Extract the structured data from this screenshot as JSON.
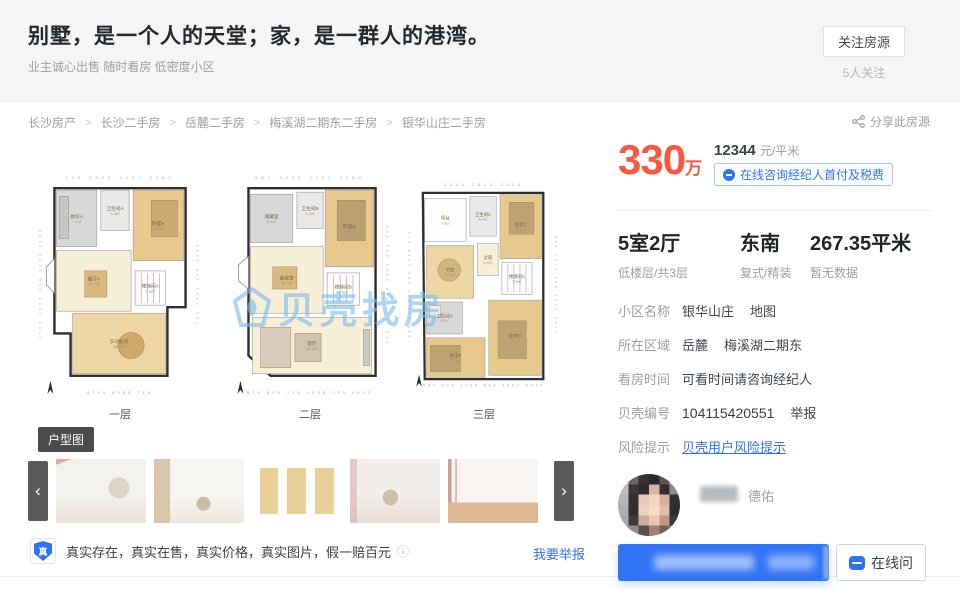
{
  "hero": {
    "title": "别墅，是一个人的天堂；家，是一群人的港湾。",
    "subtitle": "业主诚心出售 随时看房 低密度小区",
    "follow_button": "关注房源",
    "follow_count": "5人关注"
  },
  "breadcrumb": {
    "items": [
      "长沙房产",
      "长沙二手房",
      "岳麓二手房",
      "梅溪湖二期东二手房",
      "银华山庄二手房"
    ],
    "separator": ">",
    "share_label": "分享此房源"
  },
  "price": {
    "total": "330",
    "total_unit": "万",
    "unit_price": "12344",
    "unit_label": "元/平米",
    "consult_button": "在线咨询经纪人首付及税费"
  },
  "stats": [
    {
      "value": "5室2厅",
      "sub": "低楼层/共3层"
    },
    {
      "value": "东南",
      "sub": "复式/精装"
    },
    {
      "value": "267.35平米",
      "sub": "暂无数据"
    }
  ],
  "details": [
    {
      "label": "小区名称",
      "value": "银华山庄",
      "extra": "地图"
    },
    {
      "label": "所在区域",
      "value": "岳麓",
      "extra": "梅溪湖二期东"
    },
    {
      "label": "看房时间",
      "value": "可看时间请咨询经纪人",
      "extra": ""
    },
    {
      "label": "贝壳编号",
      "value": "104115420551",
      "extra": "举报"
    },
    {
      "label": "风险提示",
      "value": "贝壳用户风险提示",
      "extra": ""
    }
  ],
  "agent": {
    "brand": "德佑",
    "chat_button": "在线问"
  },
  "gallery": {
    "type_tag": "户型图",
    "prev_arrow": "‹",
    "next_arrow": "›"
  },
  "authenticity": {
    "badge": "真",
    "text": "真实存在，真实在售，真实价格，真实图片，假一赔百元",
    "info_icon": "ⓘ",
    "report_link": "我要举报"
  },
  "watermark": {
    "text": "贝壳找房"
  },
  "colors": {
    "accent_red": "#fa5741",
    "accent_blue": "#3072f6"
  },
  "floorplans": [
    {
      "caption": "一层",
      "dims_top": "719  3225  2437  3080",
      "dims_bottom": "4745  6085  719",
      "dims_left": "1767 1152 908 1262 2162",
      "dims_right": "463 4031 176 1144",
      "outline": "20,18 150,18 150,136 132,136 132,204 36,204 36,162 20,162",
      "bay": "12,96 20,88 20,122 12,114",
      "rooms": [
        {
          "x": 22,
          "y": 20,
          "w": 40,
          "h": 56,
          "fill": "gray",
          "label": "厨房A",
          "area": "7.4㎡"
        },
        {
          "x": 66,
          "y": 20,
          "w": 28,
          "h": 40,
          "fill": "lightgray",
          "label": "卫生间A",
          "area": "5.4㎡"
        },
        {
          "x": 98,
          "y": 20,
          "w": 50,
          "h": 70,
          "fill": "wood",
          "label": "卧室A",
          "area": "13.5㎡"
        },
        {
          "x": 22,
          "y": 80,
          "w": 74,
          "h": 60,
          "fill": "cream",
          "label": "餐厅A",
          "area": "25.2㎡"
        },
        {
          "x": 100,
          "y": 100,
          "w": 30,
          "h": 34,
          "fill": "white",
          "label": "楼梯间A",
          "area": "6.3㎡",
          "stairs": true
        },
        {
          "x": 38,
          "y": 142,
          "w": 92,
          "h": 60,
          "fill": "tan",
          "label": "多功能间",
          "area": "38.4㎡"
        }
      ],
      "furniture": [
        {
          "type": "rect",
          "x": 50,
          "y": 100,
          "w": 22,
          "h": 26,
          "fill": "#d9b97e"
        },
        {
          "type": "rect",
          "x": 116,
          "y": 30,
          "w": 26,
          "h": 36,
          "fill": "#cba96f"
        },
        {
          "type": "circle",
          "cx": 96,
          "cy": 174,
          "r": 13,
          "fill": "#cfa969"
        },
        {
          "type": "rect",
          "x": 25,
          "y": 26,
          "w": 9,
          "h": 42,
          "fill": "#c6c6c6"
        }
      ]
    },
    {
      "caption": "二层",
      "dims_top": "667  3309  2792  3084",
      "dims_bottom": "870 825 719 1248 735  4033",
      "dims_left": "",
      "dims_right": "748 2122 508 1084 825 407",
      "outline": "24,18 150,18 150,204 46,204 24,184",
      "bay": "14,94 24,86 24,118 14,110",
      "rooms": [
        {
          "x": 26,
          "y": 24,
          "w": 42,
          "h": 48,
          "fill": "gray",
          "label": "储藏室",
          "area": "6.3㎡"
        },
        {
          "x": 72,
          "y": 22,
          "w": 26,
          "h": 36,
          "fill": "lightgray",
          "label": "卫生间B",
          "area": "4.3㎡"
        },
        {
          "x": 100,
          "y": 20,
          "w": 48,
          "h": 76,
          "fill": "wood",
          "label": "卧室B",
          "area": "15.9㎡"
        },
        {
          "x": 26,
          "y": 76,
          "w": 72,
          "h": 66,
          "fill": "cream",
          "label": "起居室",
          "area": "19.9㎡"
        },
        {
          "x": 102,
          "y": 102,
          "w": 32,
          "h": 32,
          "fill": "white",
          "label": "楼梯间B",
          "area": "5.6㎡",
          "stairs": true
        },
        {
          "x": 28,
          "y": 146,
          "w": 118,
          "h": 56,
          "fill": "cream",
          "label": "客厅",
          "area": "44.5㎡"
        }
      ],
      "furniture": [
        {
          "type": "rect",
          "x": 48,
          "y": 96,
          "w": 24,
          "h": 22,
          "fill": "#d9b97e"
        },
        {
          "type": "rect",
          "x": 112,
          "y": 30,
          "w": 28,
          "h": 40,
          "fill": "#b99f72"
        },
        {
          "type": "rect",
          "x": 36,
          "y": 156,
          "w": 30,
          "h": 40,
          "fill": "#d8cdbc"
        },
        {
          "type": "rect",
          "x": 70,
          "y": 162,
          "w": 26,
          "h": 28,
          "fill": "#cfc4b0"
        },
        {
          "type": "rect",
          "x": 138,
          "y": 158,
          "w": 6,
          "h": 36,
          "fill": "#c9c9c9"
        }
      ]
    },
    {
      "caption": "三层",
      "dims_top": "3044  2813  3024",
      "dims_bottom": "667 909 1233 890 1307  3011",
      "dims_left": "948 672 905 994 1773 972",
      "dims_right": "1747 1024 457 2727 949",
      "outline": "20,16 148,16 148,214 22,214",
      "bay": "",
      "rooms": [
        {
          "x": 22,
          "y": 22,
          "w": 44,
          "h": 46,
          "fill": "white",
          "label": "阳台",
          "area": "7.3㎡"
        },
        {
          "x": 70,
          "y": 20,
          "w": 28,
          "h": 42,
          "fill": "lightgray",
          "label": "卫生间C",
          "area": "6.4㎡"
        },
        {
          "x": 102,
          "y": 18,
          "w": 44,
          "h": 68,
          "fill": "wood",
          "label": "卧室C",
          "area": "15.8㎡"
        },
        {
          "x": 24,
          "y": 72,
          "w": 50,
          "h": 56,
          "fill": "tan",
          "label": "书房",
          "area": "14.5㎡"
        },
        {
          "x": 78,
          "y": 70,
          "w": 22,
          "h": 34,
          "fill": "cream",
          "label": "过道",
          "area": "4.9㎡"
        },
        {
          "x": 104,
          "y": 90,
          "w": 32,
          "h": 34,
          "fill": "white",
          "label": "楼梯间C",
          "area": "5.6㎡",
          "stairs": true
        },
        {
          "x": 24,
          "y": 132,
          "w": 38,
          "h": 34,
          "fill": "gray",
          "label": "卫生间D",
          "area": "4.5㎡"
        },
        {
          "x": 24,
          "y": 170,
          "w": 62,
          "h": 42,
          "fill": "wood",
          "label": "卧室E",
          "area": "20.6㎡"
        },
        {
          "x": 90,
          "y": 130,
          "w": 56,
          "h": 80,
          "fill": "wood",
          "label": "卧室D",
          "area": "19.4㎡"
        }
      ],
      "furniture": [
        {
          "type": "rect",
          "x": 112,
          "y": 26,
          "w": 26,
          "h": 34,
          "fill": "#bfa271"
        },
        {
          "type": "circle",
          "cx": 48,
          "cy": 98,
          "r": 12,
          "fill": "#d3b57c"
        },
        {
          "type": "rect",
          "x": 28,
          "y": 178,
          "w": 32,
          "h": 28,
          "fill": "#bfa271"
        },
        {
          "type": "rect",
          "x": 100,
          "y": 152,
          "w": 30,
          "h": 40,
          "fill": "#bfa271"
        },
        {
          "type": "rect",
          "x": 27,
          "y": 136,
          "w": 12,
          "h": 12,
          "fill": "#efefef"
        }
      ]
    }
  ]
}
